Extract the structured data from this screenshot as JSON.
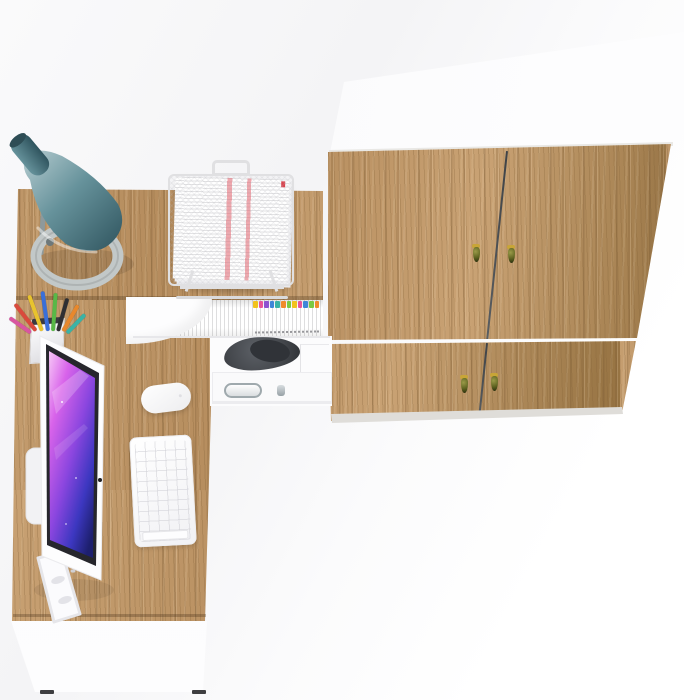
{
  "scene": {
    "type": "furniture-product-render",
    "subject": "Top view of a corner office desk set: L-shaped oak desk with monitor, keyboard, mouse, desk lamp, pencil cup, wire document tray, magazine files and under-desk drawer, next to a two-section oak wardrobe with four doors and drop handles",
    "visible_text": ""
  },
  "colors": {
    "wood_base": "#b58c5d",
    "wood_light": "#c9a274",
    "wood_dark": "#93703f",
    "seam": "#3f4347",
    "handle_body": "#5c611f",
    "handle_cap": "#c8a537",
    "lamp_shade_light": "#b7cdd1",
    "lamp_shade_mid": "#66929b",
    "lamp_shade_dark": "#2f545e",
    "lamp_base": "#c2c8c8",
    "lamp_rod": "#8e999b",
    "screen_glow": "#f7c8f7",
    "screen_magenta": "#d863ea",
    "screen_violet": "#8b46df",
    "screen_blue": "#3c37c0",
    "screen_deep": "#1d1f6e",
    "bezel": "#26262c",
    "paper_red_t": "rgba(228,96,107,0.55)",
    "wire": "#e0e0e2",
    "chrome": "#9fa9ad",
    "dark_object": "#43464b"
  },
  "wardrobe": {
    "sections": 2,
    "doors": 4,
    "handle_count": 4
  },
  "books": {
    "tab_colors": [
      "#f2c21d",
      "#e8559a",
      "#8e52d0",
      "#3f86d8",
      "#39b3a6",
      "#ef8b2b",
      "#7ac943",
      "#f2c21d",
      "#e8559a",
      "#3f86d8",
      "#7ac943",
      "#ef8b2b"
    ]
  },
  "pencil_cup": {
    "pen_colors": [
      "#d94a3c",
      "#e8c32e",
      "#3a6fd9",
      "#58b847",
      "#2f2f33",
      "#e8882c",
      "#39b3a6",
      "#d955a0"
    ]
  },
  "objects": [
    "wardrobe",
    "corner-desk",
    "desk-lamp",
    "document-tray",
    "pencil-cup",
    "magazine-files",
    "monitor",
    "keyboard",
    "mouse",
    "under-desk-drawer"
  ]
}
